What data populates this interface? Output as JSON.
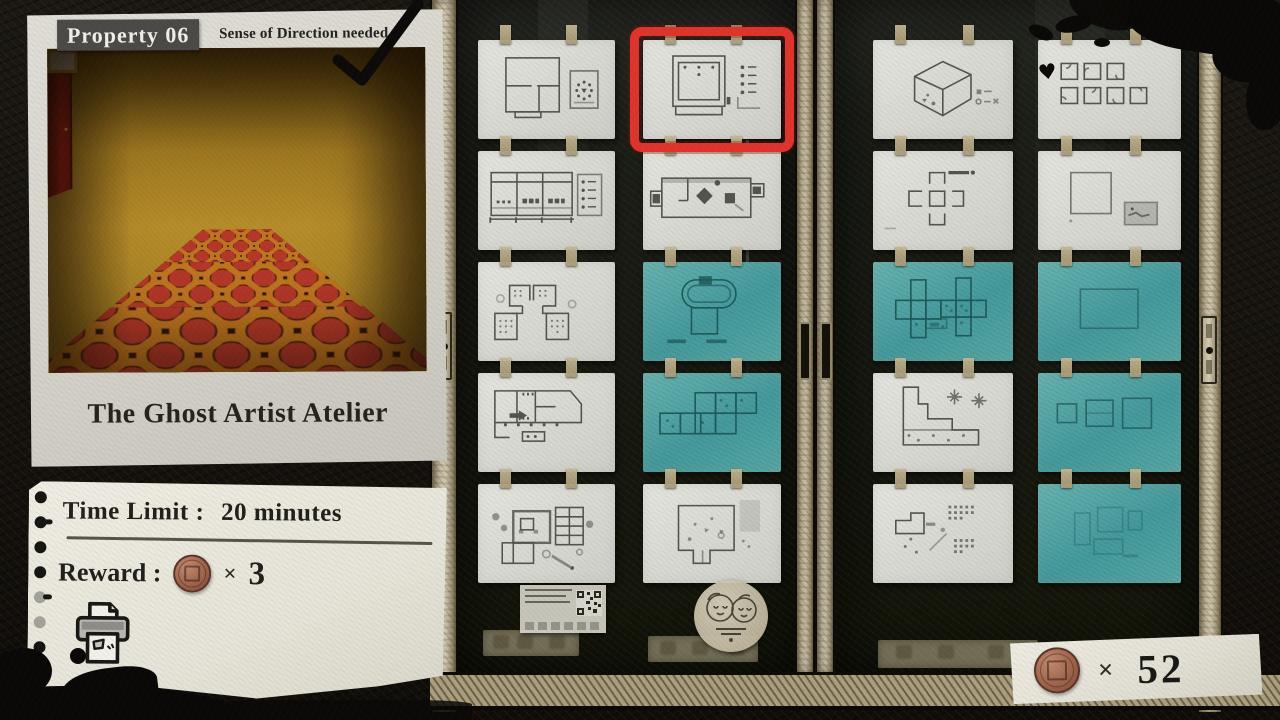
{
  "property_card": {
    "badge_label": "Property 06",
    "requirement": "Sense of Direction needed",
    "title": "The Ghost Artist Atelier",
    "completed": true
  },
  "info_note": {
    "time_limit_label": "Time Limit :",
    "time_limit_value": "20 minutes",
    "reward_label": "Reward :",
    "times_symbol": "×",
    "reward_count": "3"
  },
  "coin_wallet": {
    "times_symbol": "×",
    "coin_count": "52"
  },
  "doors": {
    "left": {
      "cells": [
        [
          {
            "color": "white",
            "sketch": "rooms-circle",
            "selected": false
          },
          {
            "color": "white",
            "sketch": "monitor-list",
            "selected": true
          }
        ],
        [
          {
            "color": "white",
            "sketch": "elevation-legend",
            "selected": false
          },
          {
            "color": "white",
            "sketch": "hall-diamonds",
            "selected": false
          }
        ],
        [
          {
            "color": "white",
            "sketch": "two-wings",
            "selected": false
          },
          {
            "color": "teal",
            "sketch": "capsule",
            "selected": false
          }
        ],
        [
          {
            "color": "white",
            "sketch": "long-arrow",
            "selected": false
          },
          {
            "color": "teal",
            "sketch": "grid-cells",
            "selected": false
          }
        ],
        [
          {
            "color": "white",
            "sketch": "complex-plan",
            "selected": false
          },
          {
            "color": "white",
            "sketch": "l-shape",
            "selected": false
          }
        ]
      ]
    },
    "right": {
      "cells": [
        [
          {
            "color": "white",
            "sketch": "cube-iso",
            "selected": false
          },
          {
            "color": "white",
            "sketch": "seven-squares",
            "selected": false
          }
        ],
        [
          {
            "color": "white",
            "sketch": "plus-shape",
            "selected": false
          },
          {
            "color": "white",
            "sketch": "single-square",
            "selected": false
          }
        ],
        [
          {
            "color": "teal",
            "sketch": "cross-grid",
            "selected": false
          },
          {
            "color": "teal",
            "sketch": "big-rect",
            "selected": false
          }
        ],
        [
          {
            "color": "white",
            "sketch": "stairs-plan",
            "selected": false
          },
          {
            "color": "teal",
            "sketch": "three-squares",
            "selected": false
          }
        ],
        [
          {
            "color": "white",
            "sketch": "plan-dots",
            "selected": false
          },
          {
            "color": "teal",
            "sketch": "faint-plan",
            "selected": false
          }
        ]
      ]
    }
  },
  "colors": {
    "selection_red": "#e0342b",
    "solved_teal": "#4b9fa1",
    "coin_copper": "#a2674e",
    "paper_white": "#dfdfd9"
  }
}
